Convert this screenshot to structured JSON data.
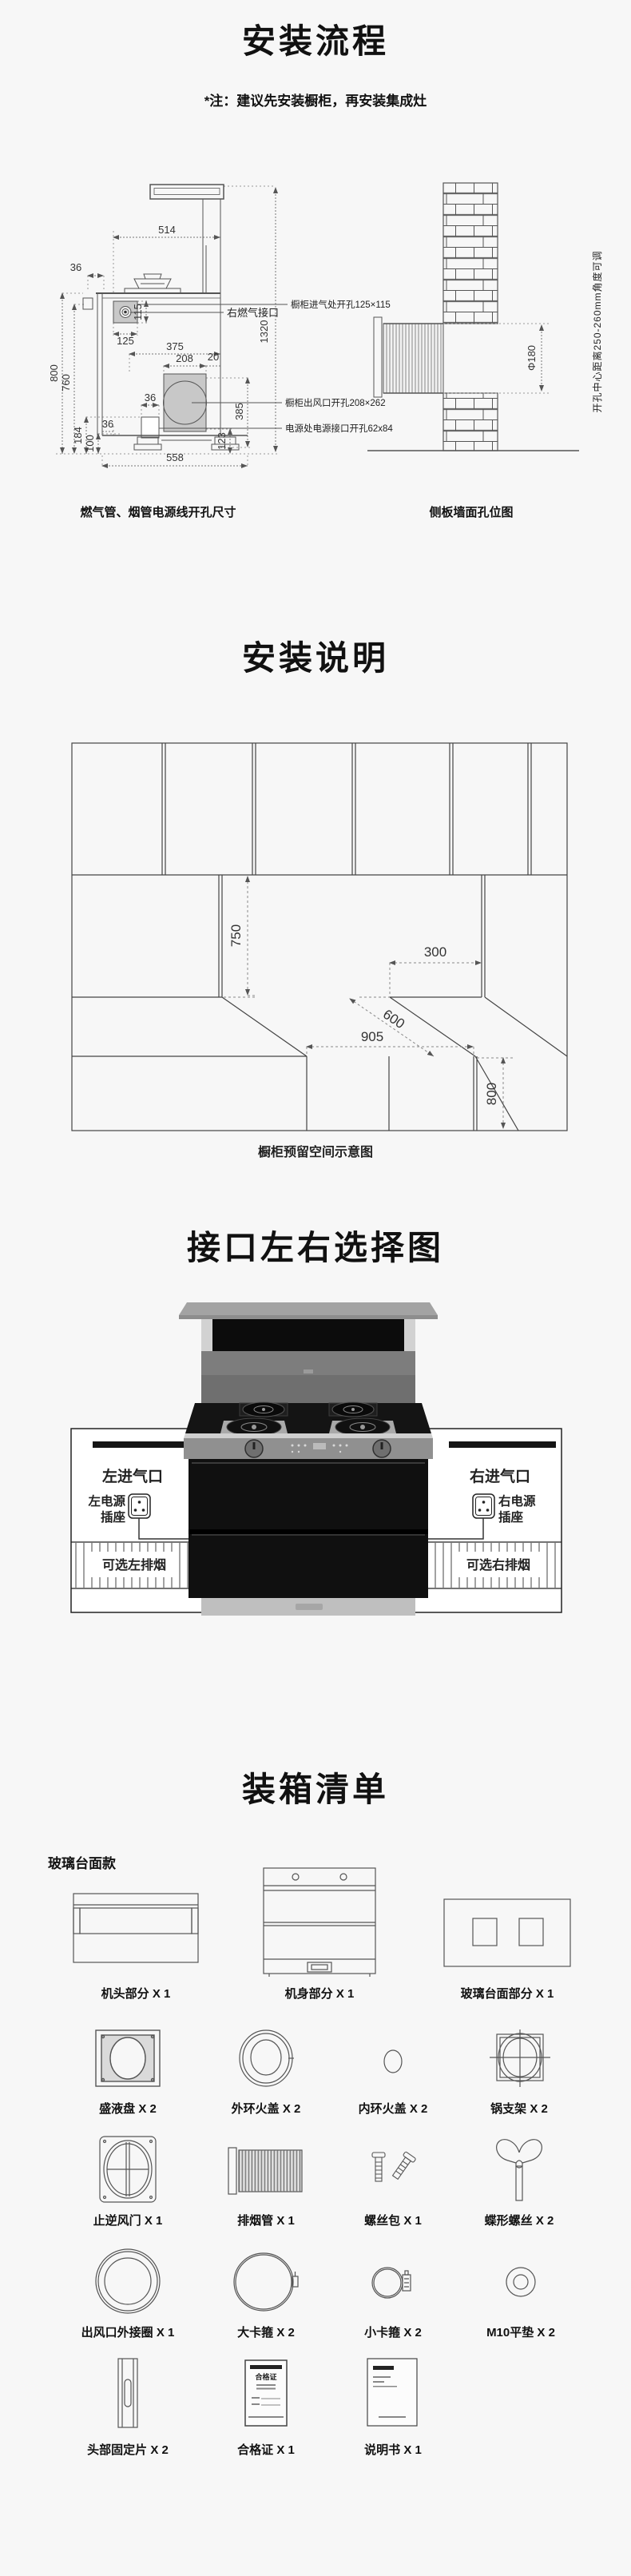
{
  "colors": {
    "bg": "#f7f7f7",
    "text": "#111111",
    "line": "#555555",
    "gray_fill": "#c8c8c8",
    "black_bar": "#151515"
  },
  "s1": {
    "title": "安装流程",
    "note": "*注：建议先安装橱柜，再安装集成灶",
    "dims": {
      "d514": "514",
      "d36_top": "36",
      "d115": "115",
      "d125": "125",
      "d375": "375",
      "d208": "208",
      "d20": "20",
      "d1320": "1320",
      "d800": "800",
      "d760": "760",
      "d36_mid": "36",
      "d36_bottom": "36",
      "d184": "184",
      "d100": "100",
      "d558": "558",
      "d123": "123",
      "d385": "385",
      "phi180": "Φ180"
    },
    "callouts": {
      "intake": "橱柜进气处开孔125×115",
      "gas": "右燃气接口",
      "outlet": "橱柜出风口开孔208×262",
      "power": "电源处电源接口开孔62x84",
      "wall_note": "开孔中心距离250-260mm角度可调"
    },
    "caption_left": "燃气管、烟管电源线开孔尺寸",
    "caption_right": "侧板墙面孔位图"
  },
  "s2": {
    "title": "安装说明",
    "dims": {
      "d750": "750",
      "d300": "300",
      "d600": "600",
      "d905": "905",
      "d800": "800"
    },
    "caption": "橱柜预留空间示意图"
  },
  "s3": {
    "title": "接口左右选择图",
    "left": {
      "inlet": "左进气口",
      "power_line1": "左电源",
      "power_line2": "插座",
      "vent": "可选左排烟"
    },
    "right": {
      "inlet": "右进气口",
      "power_line1": "右电源",
      "power_line2": "插座",
      "vent": "可选右排烟"
    }
  },
  "s4": {
    "title": "装箱清单",
    "variant": "玻璃台面款",
    "cert_title": "合格证",
    "items": [
      {
        "label": "机头部分 X 1",
        "icon": "head-unit"
      },
      {
        "label": "机身部分 X 1",
        "icon": "body-unit"
      },
      {
        "label": "玻璃台面部分 X 1",
        "icon": "glass-countertop"
      },
      {
        "label": "盛液盘 X 2",
        "icon": "drip-pan"
      },
      {
        "label": "外环火盖 X 2",
        "icon": "outer-burner-cap"
      },
      {
        "label": "内环火盖 X 2",
        "icon": "inner-burner-cap"
      },
      {
        "label": "锅支架 X 2",
        "icon": "pot-support"
      },
      {
        "label": "止逆风门 X 1",
        "icon": "check-valve-damper"
      },
      {
        "label": "排烟管 X 1",
        "icon": "exhaust-pipe"
      },
      {
        "label": "螺丝包 X 1",
        "icon": "screw-pack"
      },
      {
        "label": "蝶形螺丝 X 2",
        "icon": "wing-screw"
      },
      {
        "label": "出风口外接圈 X 1",
        "icon": "outlet-adapter-ring"
      },
      {
        "label": "大卡箍 X 2",
        "icon": "large-clamp"
      },
      {
        "label": "小卡箍 X 2",
        "icon": "small-clamp"
      },
      {
        "label": "M10平垫 X 2",
        "icon": "m10-washer"
      },
      {
        "label": "头部固定片 X 2",
        "icon": "head-fixing-plate"
      },
      {
        "label": "合格证 X 1",
        "icon": "certificate"
      },
      {
        "label": "说明书 X 1",
        "icon": "manual"
      }
    ]
  }
}
